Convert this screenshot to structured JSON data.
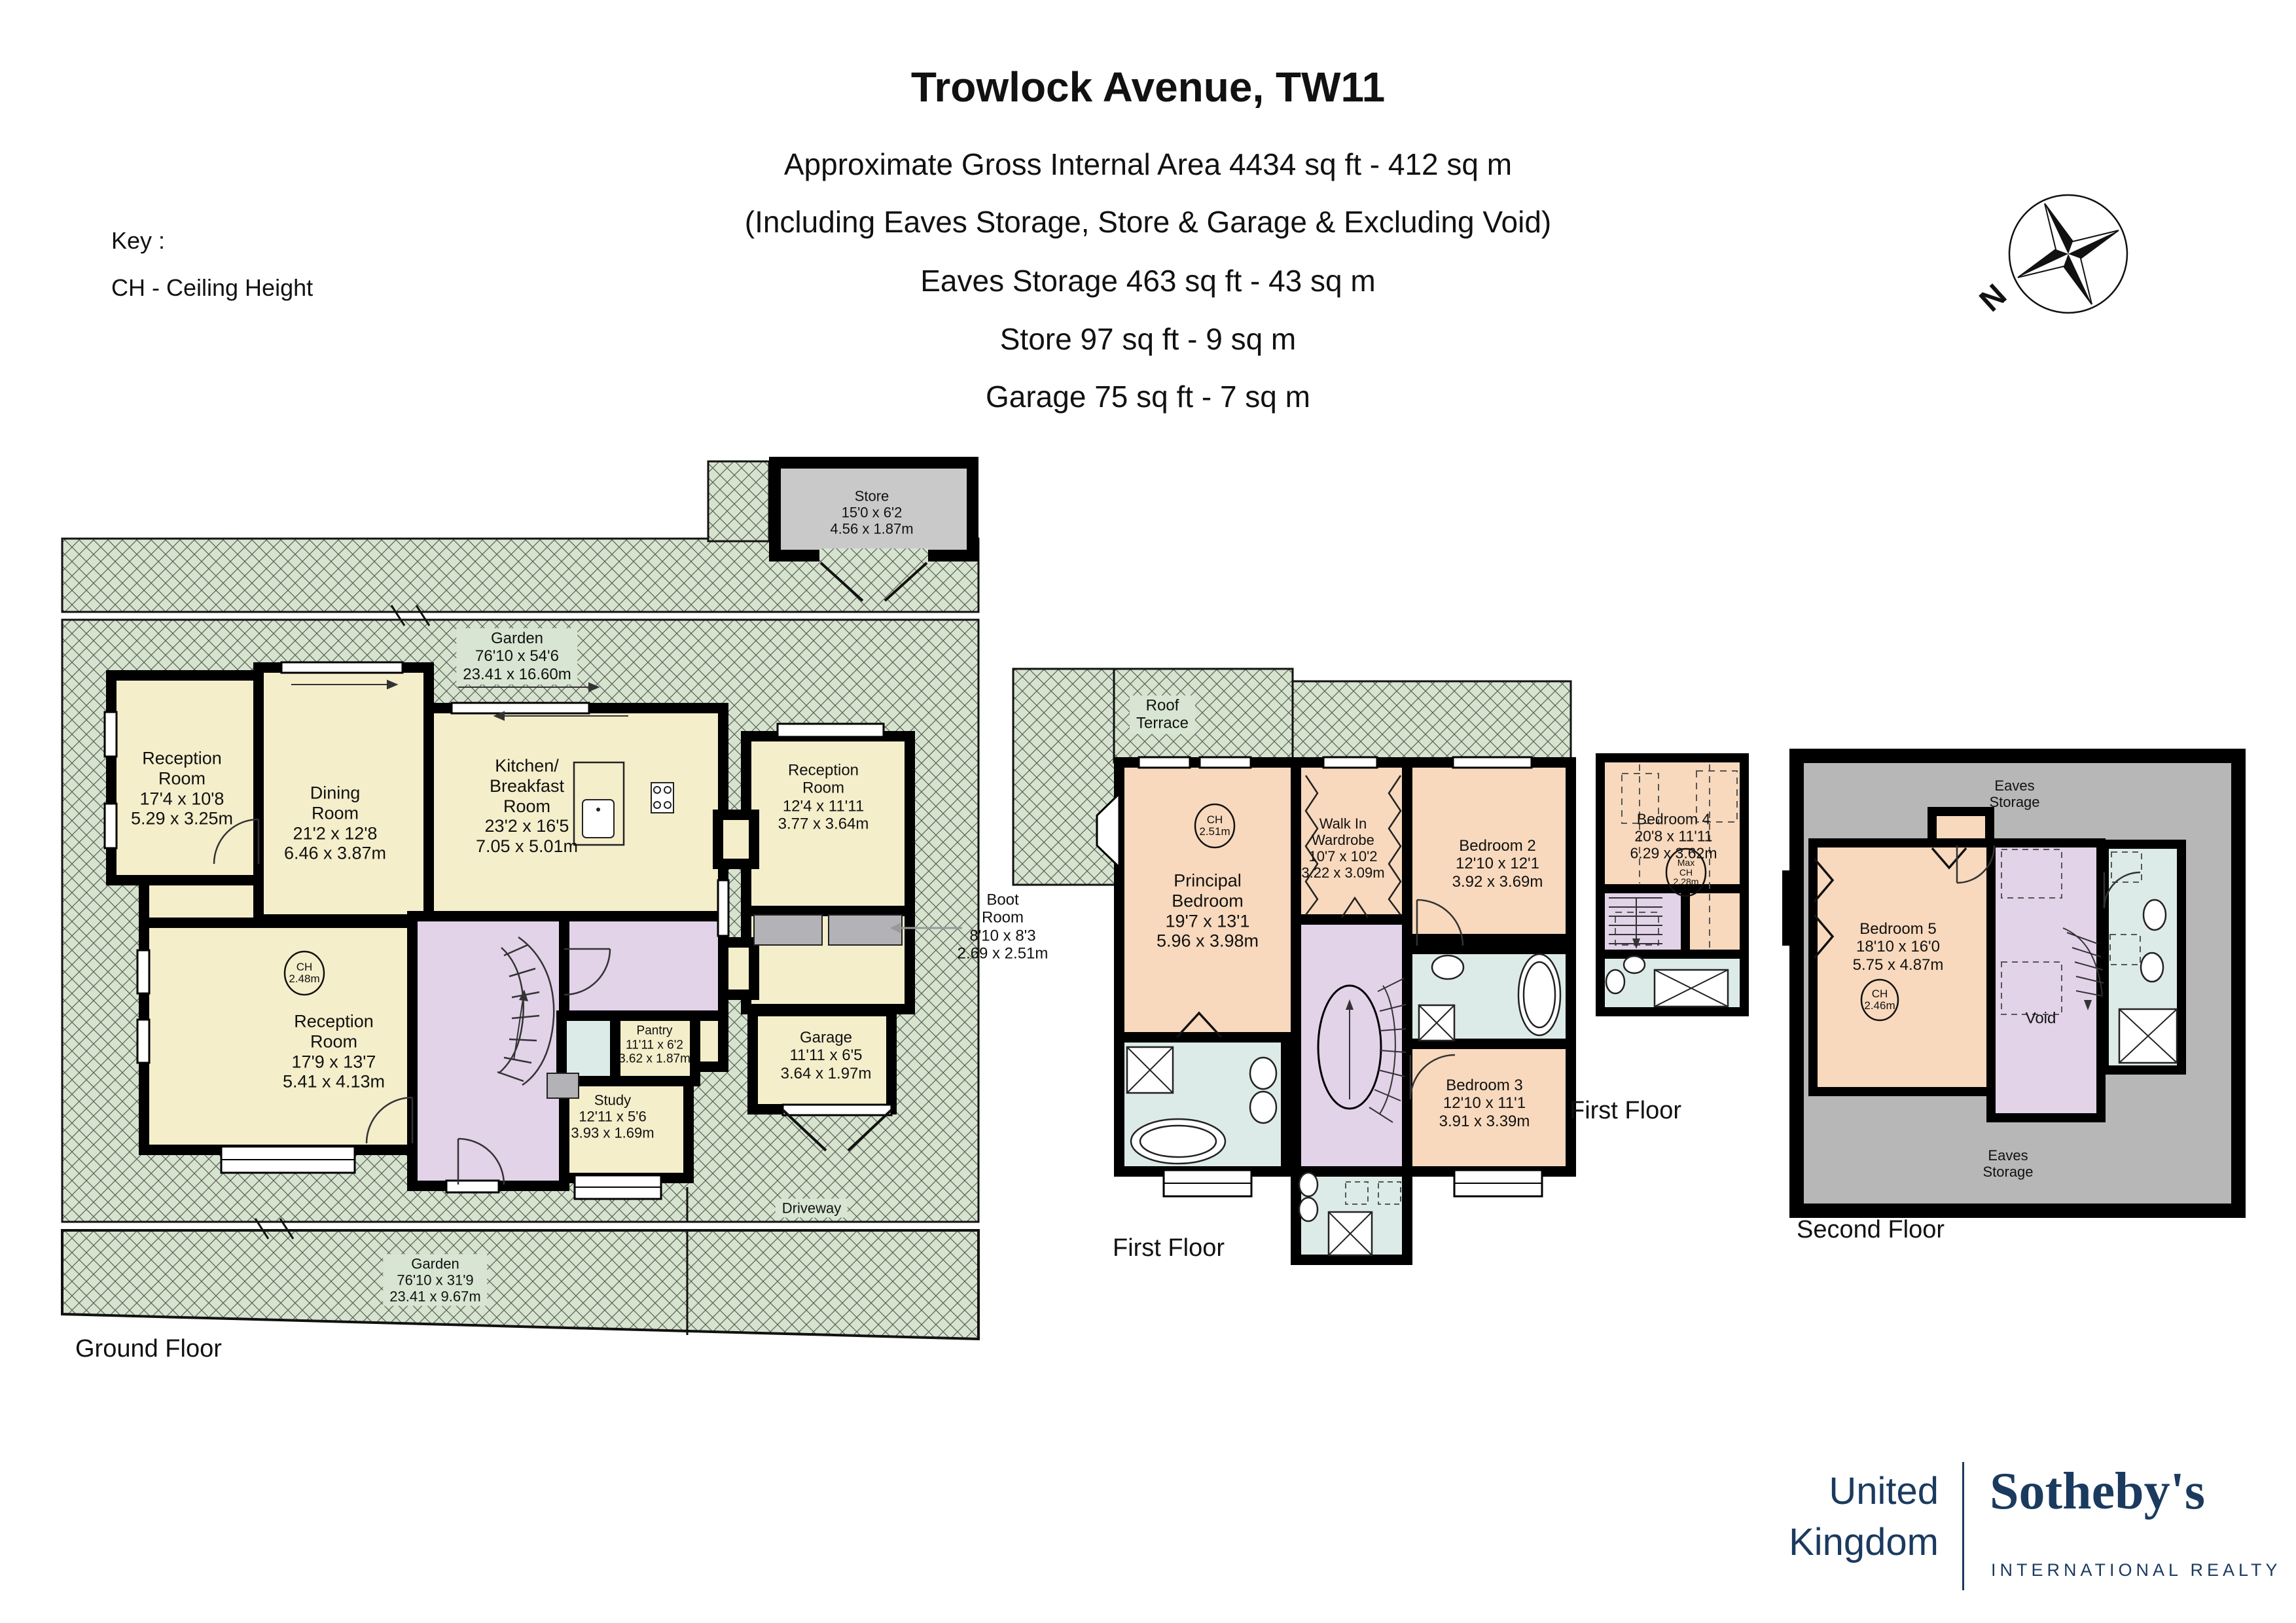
{
  "title": {
    "line1": "Trowlock Avenue, TW11",
    "line2": "Approximate Gross Internal Area 4434 sq ft - 412 sq m",
    "line3": "(Including Eaves Storage, Store & Garage & Excluding Void)",
    "line4": "Eaves Storage 463 sq ft - 43 sq m",
    "line5": "Store 97 sq ft - 9 sq m",
    "line6": "Garage 75 sq ft - 7 sq m"
  },
  "key": {
    "text": "Key :\nCH - Ceiling Height"
  },
  "compass": {
    "north": "N"
  },
  "ground": {
    "caption": "Ground Floor",
    "labels": {
      "reception_top": "Reception\nRoom\n17'4 x 10'8\n5.29 x 3.25m",
      "dining": "Dining\nRoom\n21'2 x 12'8\n6.46 x 3.87m",
      "kitchen": "Kitchen/\nBreakfast\nRoom\n23'2 x 16'5\n7.05 x 5.01m",
      "reception_right": "Reception\nRoom\n12'4 x 11'11\n3.77 x 3.64m",
      "reception_bottom": "Reception\nRoom\n17'9 x 13'7\n5.41 x 4.13m",
      "study": "Study\n12'11 x 5'6\n3.93 x 1.69m",
      "pantry": "Pantry\n11'11 x 6'2\n3.62 x 1.87m",
      "garage": "Garage\n11'11 x 6'5\n3.64 x 1.97m",
      "store": "Store\n15'0 x 6'2\n4.56 x 1.87m",
      "boot": "Boot\nRoom\n8'10 x 8'3\n2.69 x 2.51m",
      "garden_top": "Garden\n76'10 x 54'6\n23.41 x 16.60m",
      "garden_bottom": "Garden\n76'10 x 31'9\n23.41 x 9.67m",
      "driveway": "Driveway",
      "ch": "CH\n2.48m"
    }
  },
  "first": {
    "caption": "First Floor",
    "labels": {
      "roof_terrace": "Roof\nTerrace",
      "principal": "Principal\nBedroom\n19'7 x 13'1\n5.96 x 3.98m",
      "walkin": "Walk In\nWardrobe\n10'7 x 10'2\n3.22 x 3.09m",
      "bedroom2": "Bedroom 2\n12'10 x 12'1\n3.92 x 3.69m",
      "bedroom3": "Bedroom 3\n12'10 x 11'1\n3.91 x 3.39m",
      "ch": "CH\n2.51m"
    }
  },
  "first_small": {
    "caption": "First Floor",
    "labels": {
      "bedroom4": "Bedroom 4\n20'8 x 11'11\n6.29 x 3.62m",
      "max_ch": "Max\nCH\n2.28m"
    }
  },
  "second": {
    "caption": "Second Floor",
    "labels": {
      "eaves_top": "Eaves\nStorage",
      "bedroom5": "Bedroom 5\n18'10 x 16'0\n5.75 x 4.87m",
      "ch": "CH\n2.46m",
      "void": "Void",
      "eaves_bottom": "Eaves\nStorage"
    }
  },
  "brand": {
    "region": "United\nKingdom",
    "name": "Sotheby's",
    "tagline": "INTERNATIONAL REALTY"
  },
  "colors": {
    "garden_green": "#d6e3cf",
    "room_cream": "#f4eecb",
    "bedroom_peach": "#f8d9bd",
    "hall_lilac": "#e2d3e9",
    "bath_blue": "#dcebe8",
    "store_gray": "#c9c9c9",
    "eaves_gray": "#b7b7b7",
    "brand_navy": "#1b3a5f"
  }
}
